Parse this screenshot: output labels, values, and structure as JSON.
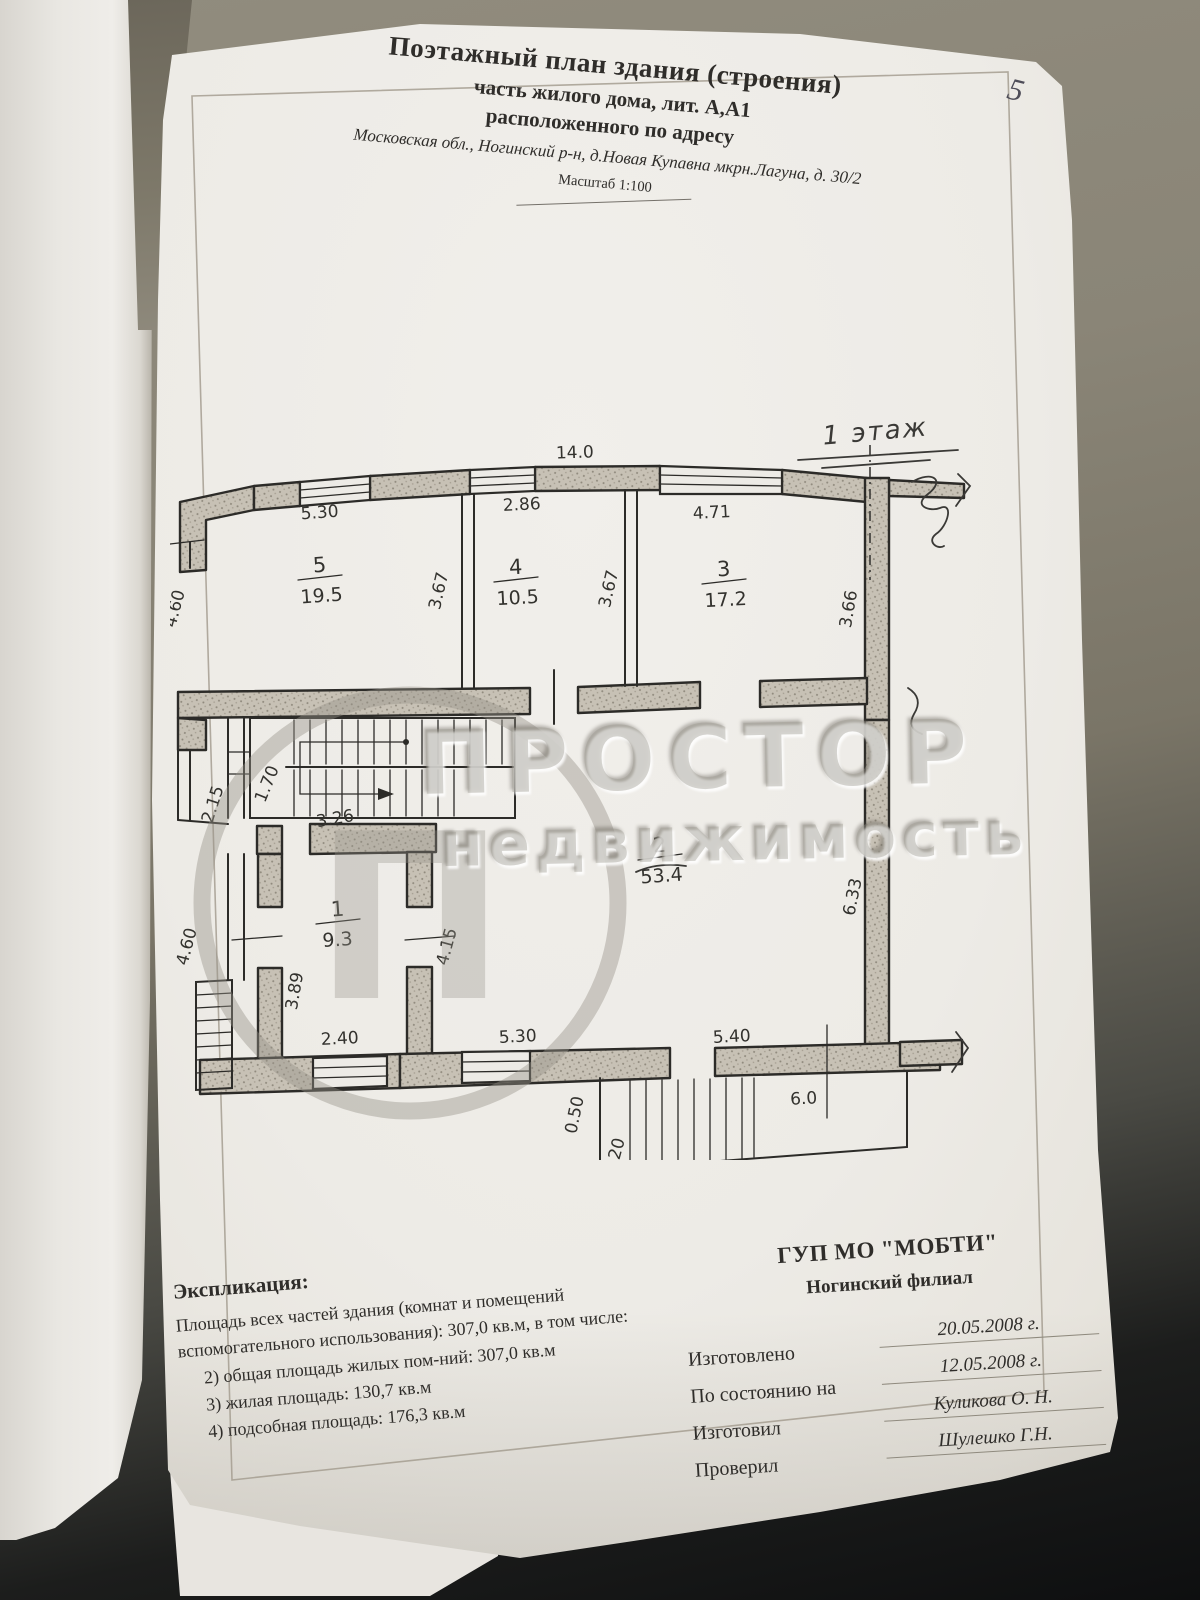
{
  "page": {
    "page_number": "5",
    "title_line1": "Поэтажный план здания (строения)",
    "title_line2": "часть жилого дома,  лит. А,А1",
    "title_line3": "расположенного по адресу",
    "address": "Московская обл., Ногинский р-н, д.Новая Купавна мкрн.Лагуна, д. 30/2",
    "scale": "Масштаб  1:100"
  },
  "plan": {
    "floor_label": "1 этаж",
    "rooms": [
      {
        "number": "5",
        "area": "19.5"
      },
      {
        "number": "4",
        "area": "10.5"
      },
      {
        "number": "3",
        "area": "17.2"
      },
      {
        "number": "2",
        "area": "53.4"
      },
      {
        "number": "1",
        "area": "9.3"
      }
    ],
    "dims": {
      "top_total": "14.0",
      "room5_w": "5.30",
      "room4_w": "2.86",
      "room3_w": "4.71",
      "room4_d_left": "3.67",
      "room4_d_right": "3.67",
      "right_d": "3.66",
      "left_d": "4.60",
      "stair_w": "2.15",
      "stair_flight": "1.70",
      "stair_len": "3.26",
      "room1_left": "3.89",
      "room1_right": "4.15",
      "room1_w": "2.40",
      "left_lower": "4.60",
      "room2_right": "6.33",
      "bottom_w1": "5.30",
      "bottom_w2": "5.40",
      "porch_w": "6.0",
      "porch_off": "0.50",
      "porch_d": "1.20"
    }
  },
  "watermark": {
    "logo_letter": "П",
    "line1": "ПРОСТОР",
    "line2": "недвижимость"
  },
  "explication": {
    "heading": "Экспликация:",
    "line1": "Площадь всех частей здания (комнат и помещений",
    "line2": "вспомогательного использования): 307,0 кв.м,  в том числе:",
    "items": [
      "2) общая площадь жилых пом-ний: 307,0 кв.м",
      "3) жилая площадь: 130,7 кв.м",
      "4) подсобная площадь: 176,3 кв.м"
    ]
  },
  "org": {
    "name": "ГУП МО \"МОБТИ\"",
    "branch": "Ногинский филиал",
    "rows": [
      {
        "label": "Изготовлено",
        "value": "20.05.2008 г."
      },
      {
        "label": "По состоянию на",
        "value": "12.05.2008 г."
      },
      {
        "label": "Изготовил",
        "value": "Куликова О. Н."
      },
      {
        "label": "Проверил",
        "value": "Шулешко Г.Н."
      }
    ]
  },
  "colors": {
    "paper": "#edebe6",
    "ink": "#2c2b28",
    "pencil": "#4e4d58",
    "watermark": "#9c988f",
    "background_top": "#8a8577",
    "background_bottom": "#0e0f10"
  }
}
